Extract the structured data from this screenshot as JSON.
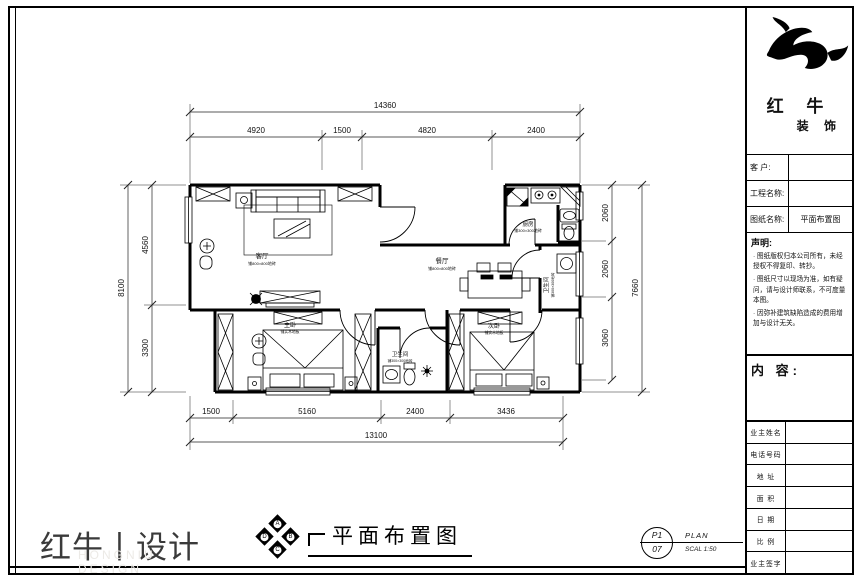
{
  "title_block": {
    "brand": {
      "line1": "红 牛",
      "line2": "装 饰"
    },
    "fields": [
      {
        "label": "客  户:",
        "value": ""
      },
      {
        "label": "工程名称:",
        "value": ""
      },
      {
        "label": "图纸名称:",
        "value": "平面布置图"
      }
    ],
    "statement": {
      "heading": "声明:",
      "items": [
        "图纸版权归本公司所有，未经授权不得复印、转抄。",
        "图纸尺寸以现场为准，如有疑问，请与设计师联系，不可度量本图。",
        "因弥补建筑缺陷造成的费用增加与设计无关。"
      ]
    },
    "content_heading": "内 容:",
    "rows": [
      {
        "label": "业主姓名"
      },
      {
        "label": "电话号码"
      },
      {
        "label": "地  址"
      },
      {
        "label": "面  积"
      },
      {
        "label": "日  期"
      },
      {
        "label": "比  例"
      },
      {
        "label": "业主签字"
      }
    ]
  },
  "footer": {
    "logo_text": "红牛丨设计",
    "logo_sub": "HONGNIU DESIGN",
    "compass_letters": [
      "A",
      "B",
      "C",
      "D"
    ],
    "drawing_title": "平面布置图",
    "stamp": {
      "top": "P1",
      "bottom": "07",
      "label": "PLAN",
      "scale": "SCAL 1:50"
    }
  },
  "plan": {
    "dimensions": {
      "top": {
        "total": "14360",
        "segments": [
          "4920",
          "1500",
          "4820",
          "2400"
        ]
      },
      "bottom": {
        "total": "13100",
        "segments": [
          "1500",
          "5160",
          "2400",
          "3436"
        ]
      },
      "left": {
        "total": "8100",
        "segments": [
          "4560",
          "3300"
        ]
      },
      "right": {
        "total": "7660",
        "segments": [
          "2060",
          "2060",
          "3060"
        ]
      }
    },
    "rooms": {
      "living": {
        "name": "客厅",
        "note": "铺800×800地砖"
      },
      "dining": {
        "name": "餐厅",
        "note": "铺800×800地砖"
      },
      "kitchen": {
        "name": "厨房",
        "note": "铺300×300地砖"
      },
      "bath_right": {
        "name": "卫生间",
        "note": "铺300×300地砖"
      },
      "bath_mid": {
        "name": "卫生间",
        "note": "铺300×300地砖"
      },
      "master": {
        "name": "主卧",
        "note": "铺实木地板"
      },
      "second": {
        "name": "次卧",
        "note": "铺实木地板"
      }
    }
  }
}
